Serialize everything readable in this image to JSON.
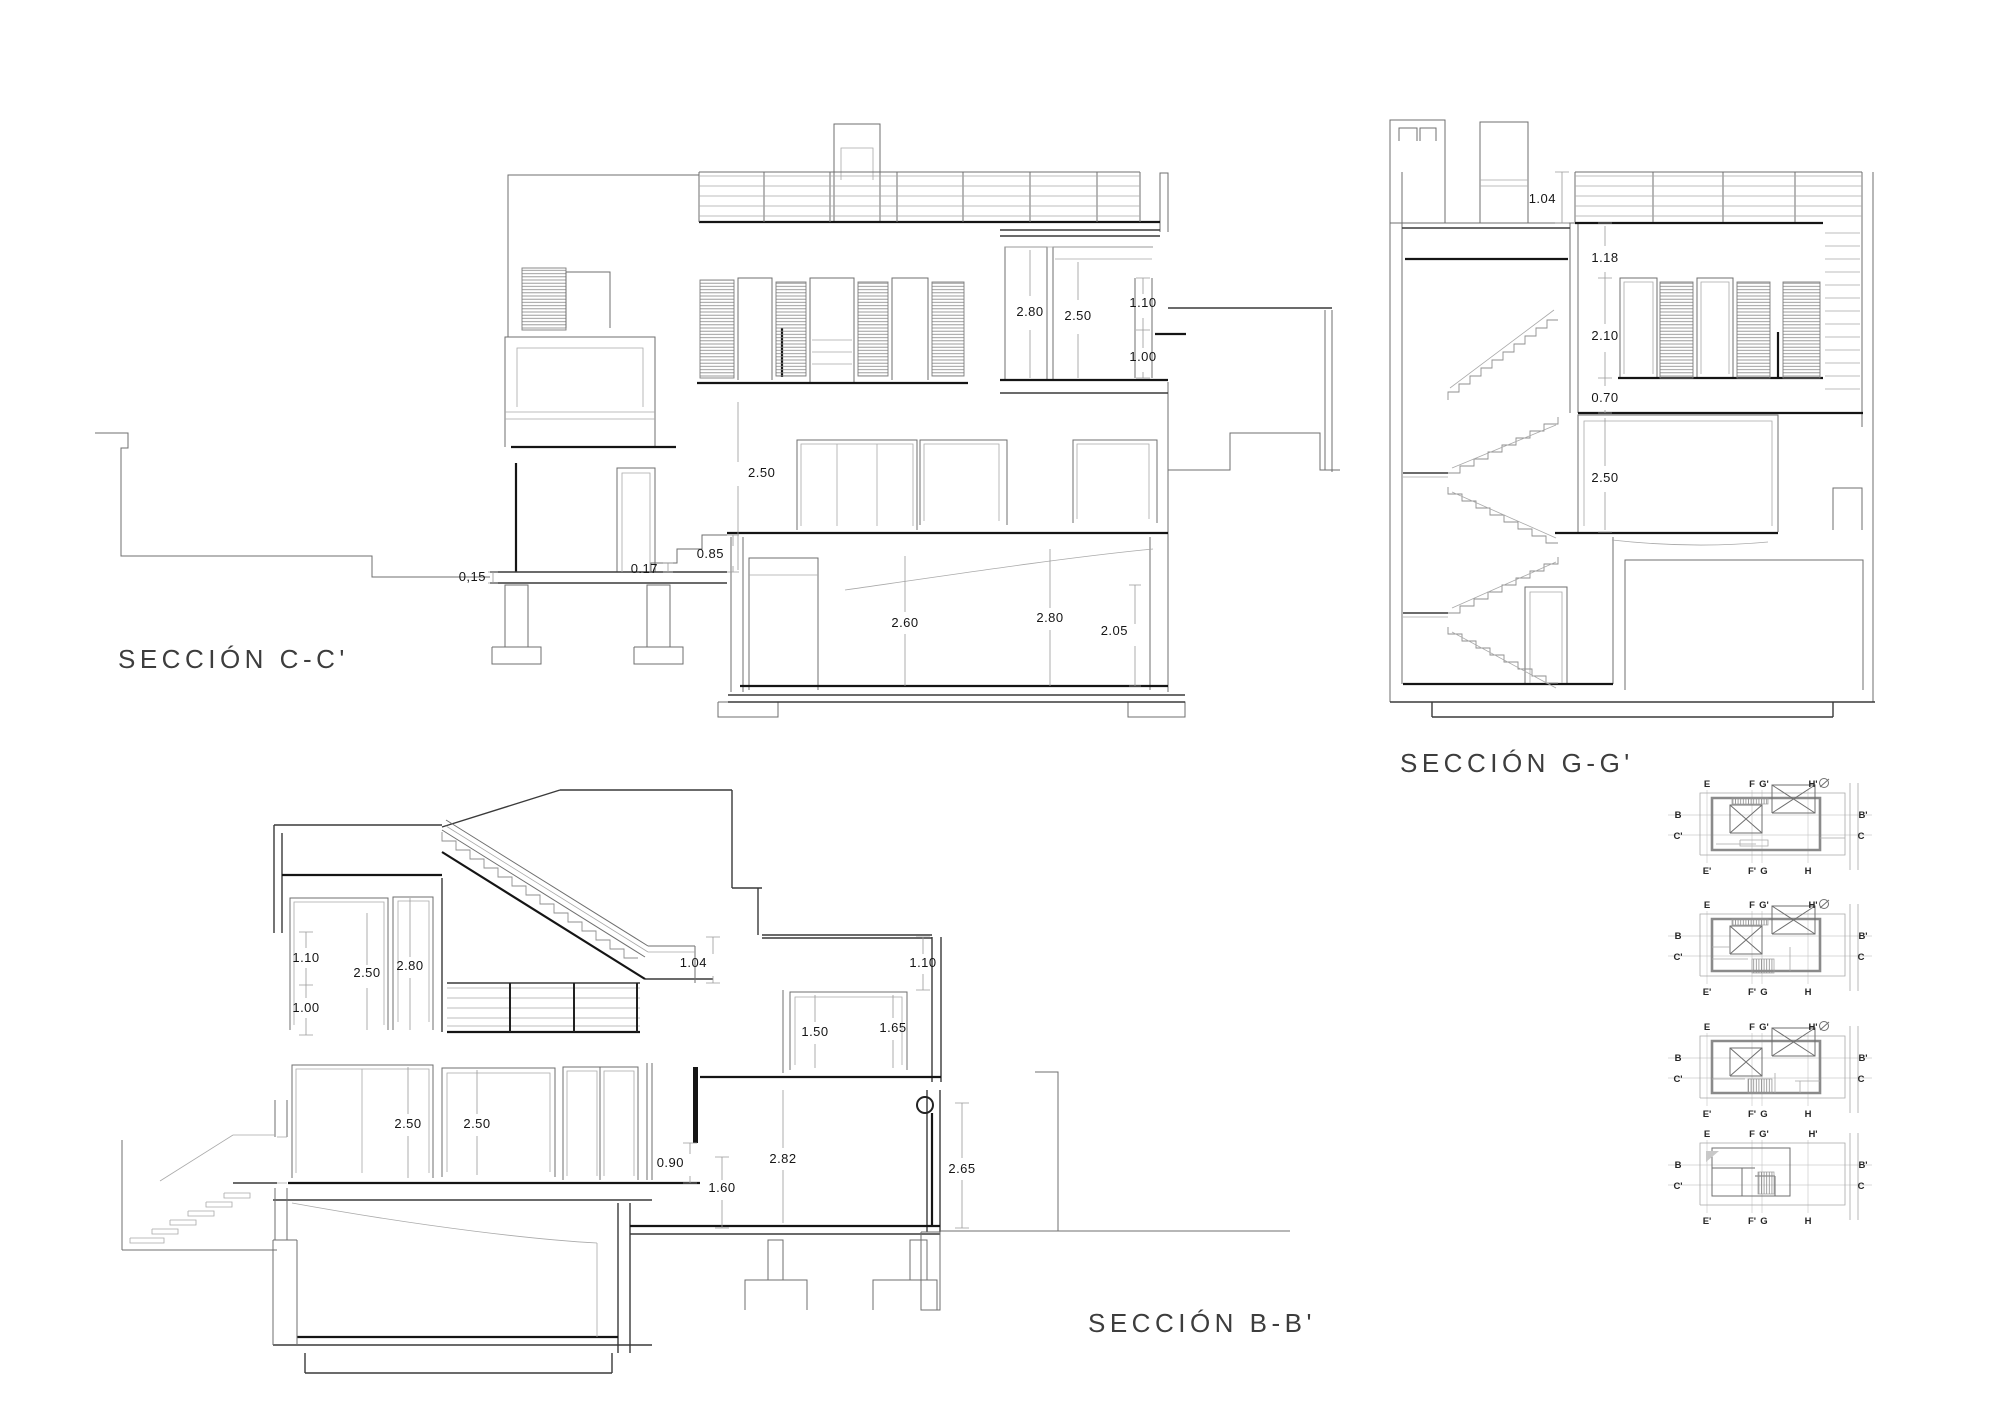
{
  "sections": {
    "cc": {
      "title": "SECCIÓN C-C'",
      "dims": {
        "upper_room_a": "2.80",
        "upper_room_b": "2.50",
        "window_upper": "1.10",
        "window_lower": "1.00",
        "ground_room": "2.50",
        "step_total": "0.85",
        "step_riser": "0.17",
        "plinth": "0,15",
        "basement_a": "2.60",
        "basement_b": "2.80",
        "basement_c": "2.05"
      }
    },
    "gg": {
      "title": "SECCIÓN G-G'",
      "dims": {
        "railing": "1.04",
        "parapet": "1.18",
        "window": "2.10",
        "sill": "0.70",
        "room": "2.50"
      }
    },
    "bb": {
      "title": "SECCIÓN B-B'",
      "dims": {
        "window_upper": "1.10",
        "room_a": "2.50",
        "room_b": "2.80",
        "window_lower": "1.00",
        "railing": "1.04",
        "right_window": "1.10",
        "mezz_a": "1.50",
        "mezz_b": "1.65",
        "ground_a": "2.50",
        "ground_b": "2.50",
        "parapet": "0.90",
        "lower_room": "2.82",
        "step": "1.60",
        "right_room": "2.65"
      }
    }
  },
  "key_plans": {
    "labels": {
      "e": "E",
      "f": "F",
      "g_prime": "G'",
      "h_prime": "H'",
      "e_prime": "E'",
      "f_prime": "F'",
      "g": "G",
      "h": "H",
      "b": "B",
      "c_prime": "C'",
      "b_prime": "B'",
      "c": "C"
    }
  }
}
